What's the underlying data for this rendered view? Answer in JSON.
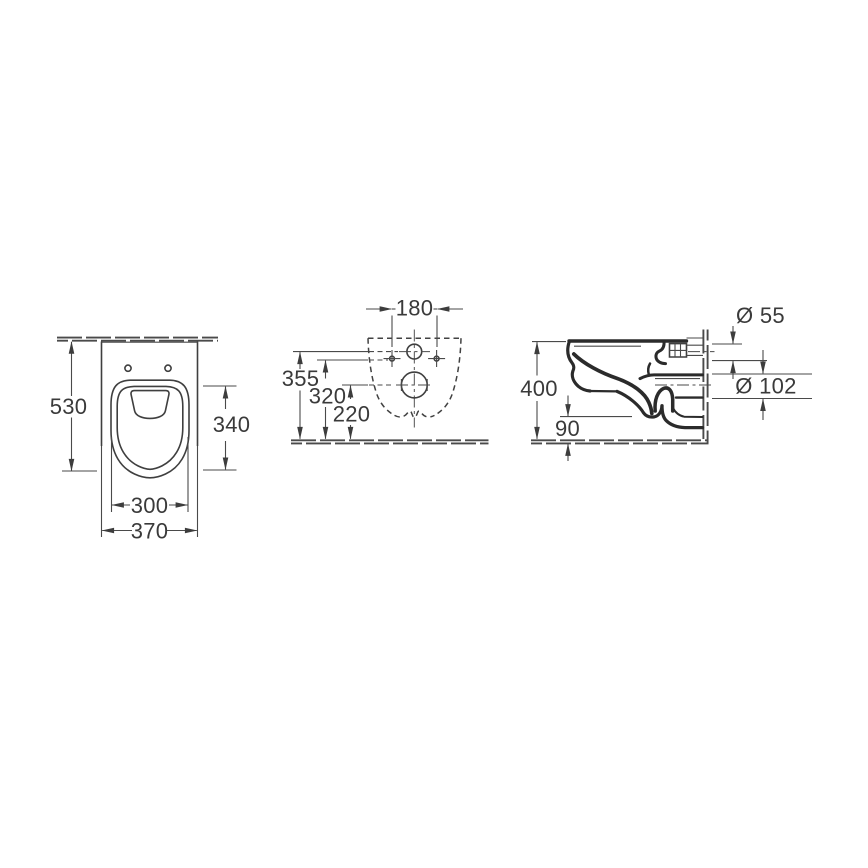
{
  "views": {
    "front": {
      "overall_height": "530",
      "bowl_length": "340",
      "bowl_width": "300",
      "overall_width": "370"
    },
    "top": {
      "bolt_spacing": "180",
      "inlet_center_height": "355",
      "bolt_center_height": "320",
      "outlet_center_height": "220"
    },
    "side": {
      "inlet_diameter": "Ø 55",
      "outlet_diameter": "Ø 102",
      "mounting_height": "400",
      "underside_clearance": "90"
    }
  },
  "colors": {
    "background": "#ffffff",
    "thin_line": "#4a4a4a",
    "heavy_line": "#2b2b2b",
    "text": "#3a3a3a"
  }
}
